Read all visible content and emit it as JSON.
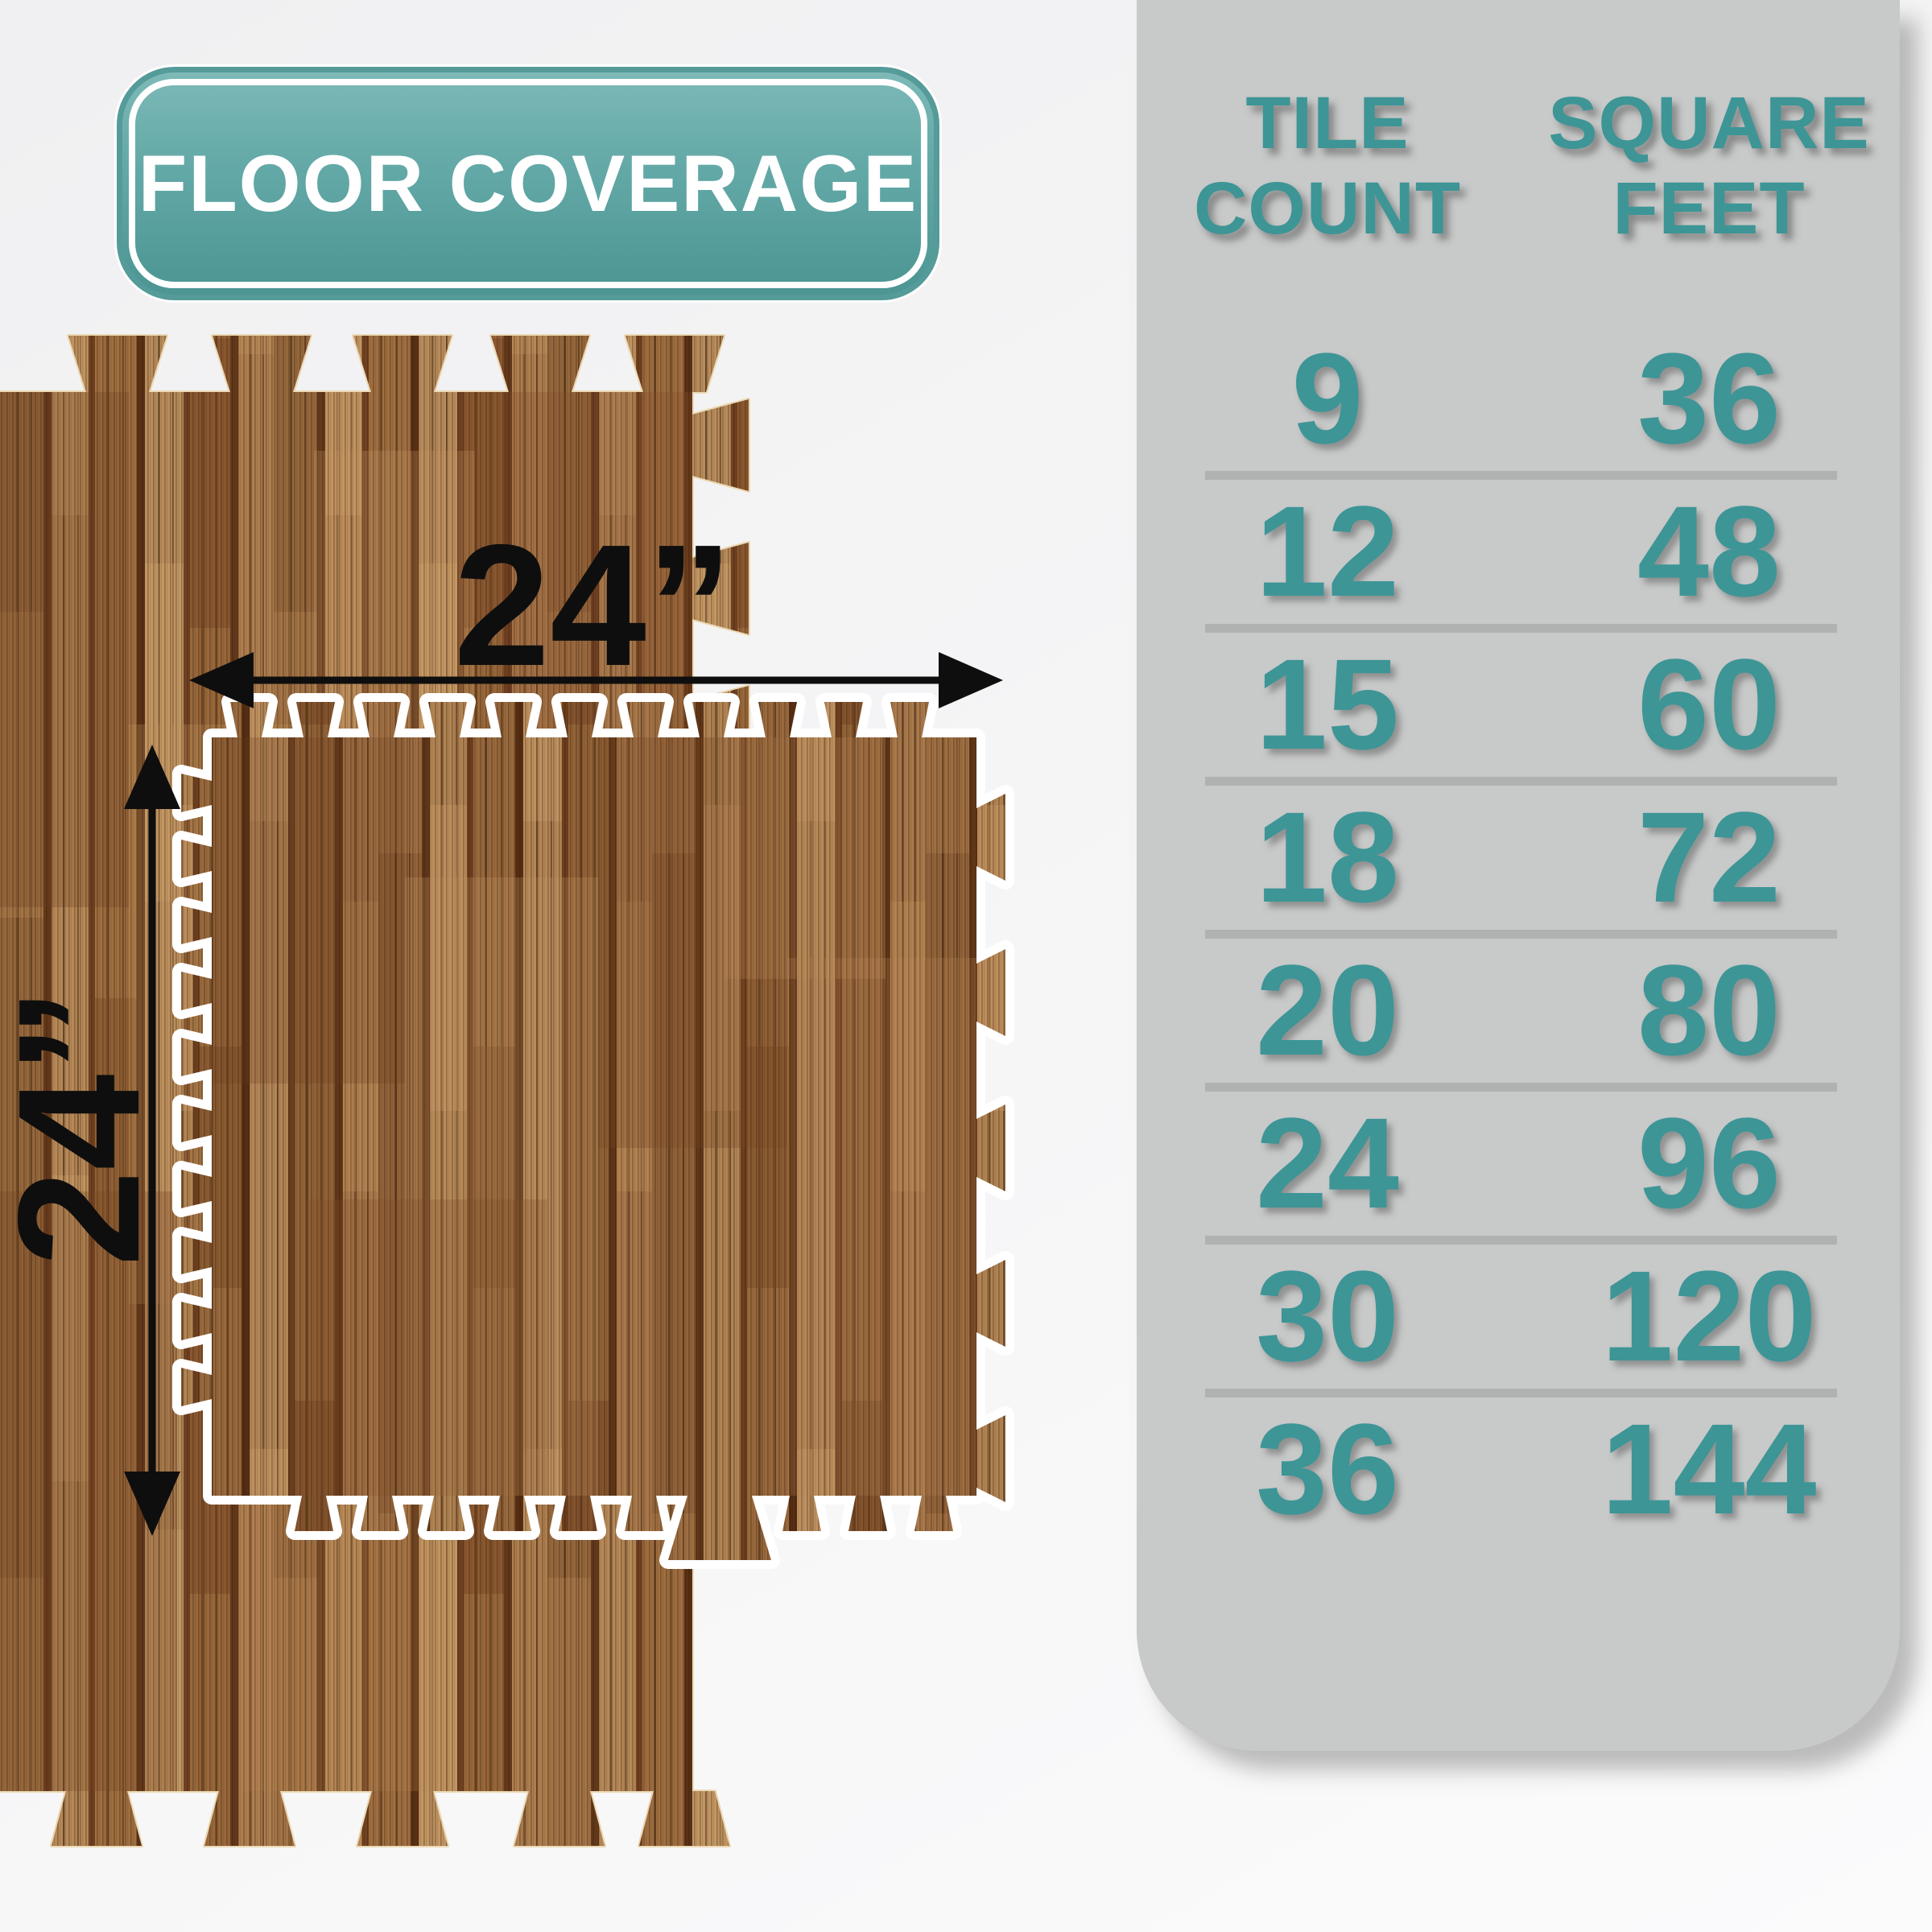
{
  "badge": {
    "label": "FLOOR COVERAGE"
  },
  "diagram": {
    "width_label": "24”",
    "height_label": "24”"
  },
  "coverage_table": {
    "headers": [
      {
        "line1": "TILE",
        "line2": "COUNT"
      },
      {
        "line1": "SQUARE",
        "line2": "FEET"
      }
    ],
    "rows": [
      {
        "tile_count": "9",
        "square_feet": "36"
      },
      {
        "tile_count": "12",
        "square_feet": "48"
      },
      {
        "tile_count": "15",
        "square_feet": "60"
      },
      {
        "tile_count": "18",
        "square_feet": "72"
      },
      {
        "tile_count": "20",
        "square_feet": "80"
      },
      {
        "tile_count": "24",
        "square_feet": "96"
      },
      {
        "tile_count": "30",
        "square_feet": "120"
      },
      {
        "tile_count": "36",
        "square_feet": "144"
      }
    ]
  },
  "colors": {
    "accent_teal": "#3d9596",
    "badge_teal_top": "#7cb9b7",
    "badge_teal_bottom": "#4c9593",
    "panel_gray": "#c8c9c9",
    "divider_gray": "#b0b2b1",
    "wood_brown": "#a97a4c",
    "dimension_black": "#0e0e0e",
    "tile_outline_white": "#ffffff"
  }
}
